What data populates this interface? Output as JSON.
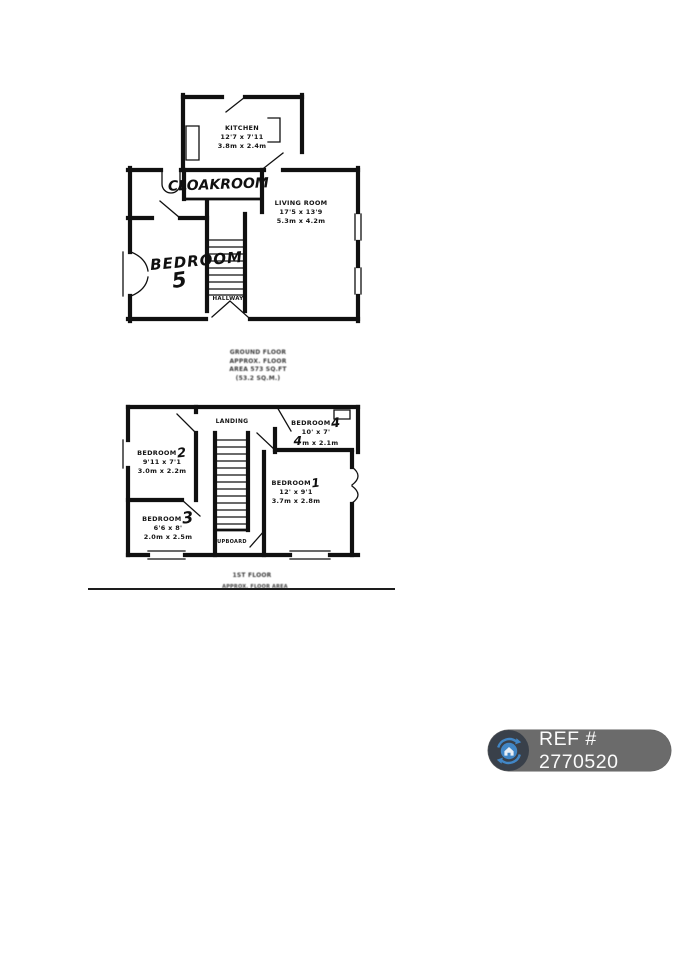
{
  "ground_floor": {
    "kitchen": {
      "name": "KITCHEN",
      "imperial": "12'7 x 7'11",
      "metric": "3.8m x 2.4m"
    },
    "living_room": {
      "name": "LIVING ROOM",
      "imperial": "17'5 x 13'9",
      "metric": "5.3m x 4.2m"
    },
    "hallway": {
      "name": "HALLWAY"
    },
    "cloakroom_handwritten": "CLOAKROOM",
    "bedroom5": {
      "name": "BEDROOM",
      "number": "5"
    },
    "caption": [
      "GROUND FLOOR",
      "APPROX. FLOOR",
      "AREA 573 SQ.FT",
      "(53.2 SQ.M.)"
    ]
  },
  "first_floor": {
    "landing": {
      "name": "LANDING"
    },
    "bedroom2": {
      "name": "BEDROOM",
      "number": "2",
      "imperial": "9'11 x 7'1",
      "metric": "3.0m x 2.2m"
    },
    "bedroom3": {
      "name": "BEDROOM",
      "number": "3",
      "imperial": "6'6 x 8'",
      "metric": "2.0m x 2.5m"
    },
    "bedroom4": {
      "name": "BEDROOM",
      "number": "4",
      "imperial": "10' x 7'",
      "metric": "m x 2.1m",
      "metric_handwritten_prefix": "4"
    },
    "bedroom1": {
      "name": "BEDROOM",
      "number": "1",
      "imperial": "12' x 9'1",
      "metric": "3.7m x 2.8m"
    },
    "cupboard": {
      "name": "CUPBOARD"
    },
    "caption": [
      "1ST FLOOR",
      "APPROX. FLOOR AREA"
    ]
  },
  "badge": {
    "text": "REF # 2770520",
    "pill_color": "#6b6b6b",
    "icon_background": "#39404a",
    "icon_blue": "#4186c6",
    "icon": "house-sync-icon"
  }
}
